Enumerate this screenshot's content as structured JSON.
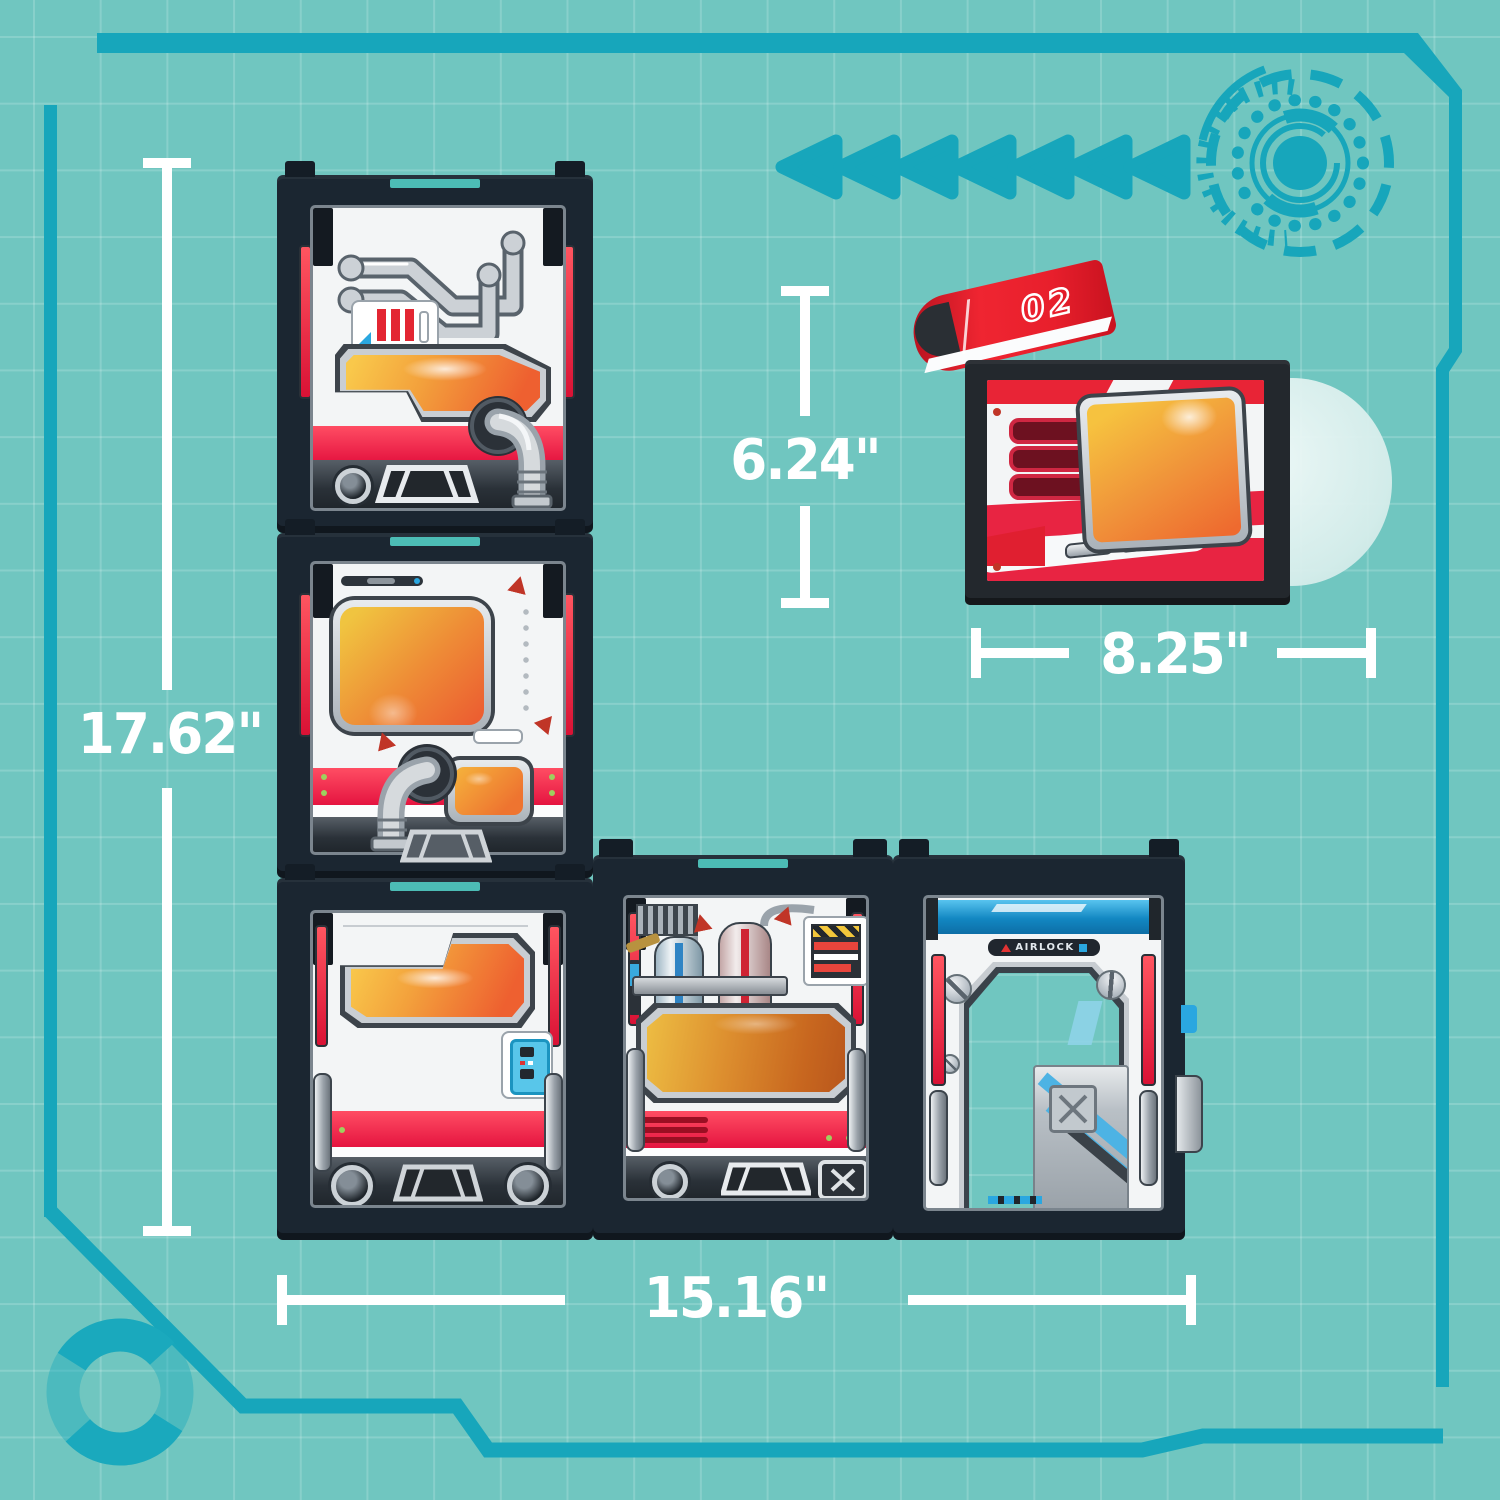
{
  "dimensions": {
    "stack_height": {
      "value": "17.62\"",
      "orientation": "vertical"
    },
    "small_module_height": {
      "value": "6.24\"",
      "orientation": "vertical"
    },
    "small_module_width": {
      "value": "8.25\"",
      "orientation": "horizontal"
    },
    "row_width": {
      "value": "15.16\"",
      "orientation": "horizontal"
    }
  },
  "labels": {
    "airlock": "AIRLOCK",
    "fin_number": "02"
  },
  "colors": {
    "background": "#70c6c0",
    "grid_line": "#8fd2cc",
    "hud_accent": "#17a6bb",
    "dimension_text": "#ffffff",
    "module_frame": "#1b2631",
    "panel_white": "#f3f5f6",
    "stripe_red": "#ee1c45",
    "window_orange": "#f0863a",
    "airlock_blue": "#2aa7e0",
    "connector_teal": "#4cbcb5",
    "fin_red": "#ef2531"
  },
  "decorations": {
    "left_arrows": {
      "icon": "left-arrow-icon",
      "count": 7
    },
    "dial": "tech-dial-icon",
    "ring": "ring-icon",
    "frame": "hud-corner-frame"
  },
  "modules": [
    {
      "name": "pipes-module"
    },
    {
      "name": "porthole-module"
    },
    {
      "name": "cargo-window-module"
    },
    {
      "name": "tank-module"
    },
    {
      "name": "airlock-module"
    },
    {
      "name": "detached-screen-module"
    }
  ]
}
